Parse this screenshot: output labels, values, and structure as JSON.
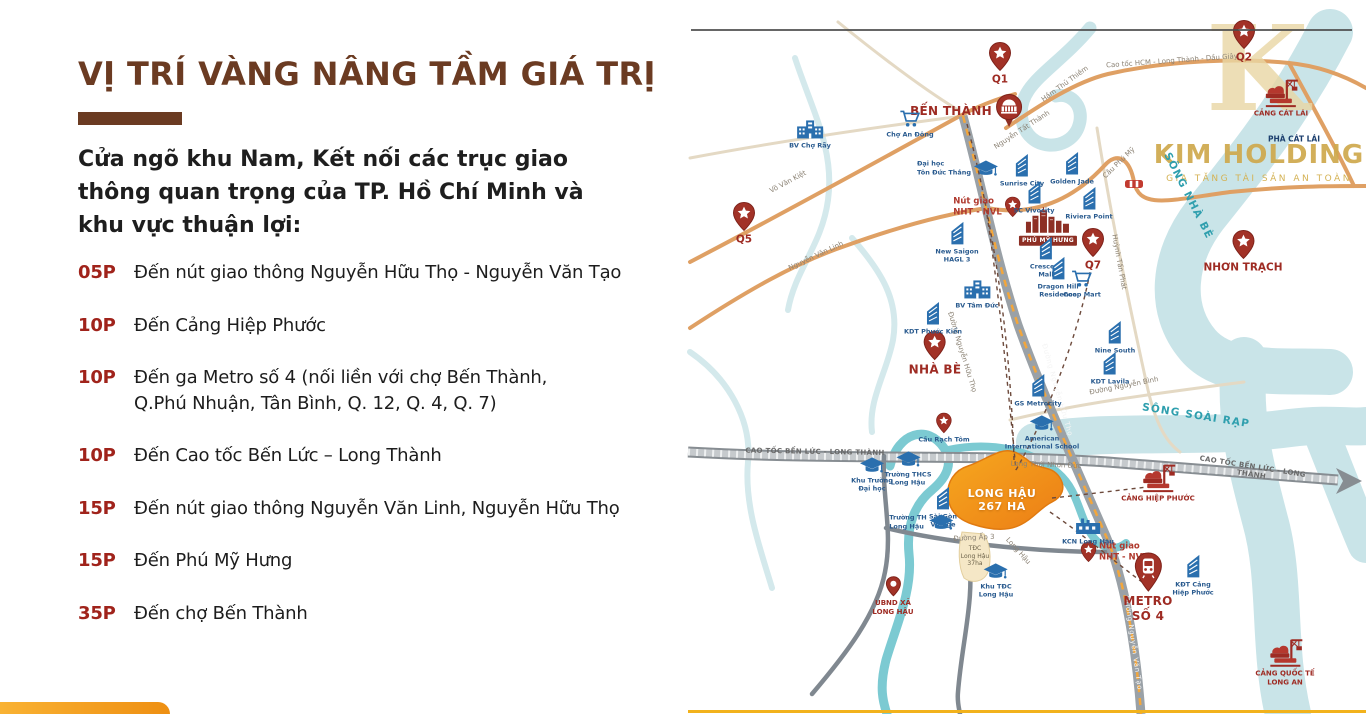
{
  "left": {
    "title": "VỊ TRÍ VÀNG NÂNG TẦM GIÁ TRỊ",
    "intro_lines": [
      "Cửa ngõ khu Nam, Kết nối các trục giao",
      "thông quan trọng của TP. Hồ Chí Minh và",
      "khu vực thuận lợi:"
    ],
    "items": [
      {
        "time": "05P",
        "text": "Đến nút giao thông Nguyễn Hữu Thọ - Nguyễn Văn Tạo"
      },
      {
        "time": "10P",
        "text": "Đến Cảng Hiệp Phước"
      },
      {
        "time": "10P",
        "text": "Đến ga Metro số 4 (nối liền với chợ Bến Thành,\nQ.Phú Nhuận, Tân Bình, Q. 12, Q. 4, Q. 7)"
      },
      {
        "time": "10P",
        "text": "Đến Cao tốc Bến Lức – Long Thành"
      },
      {
        "time": "15P",
        "text": "Đến nút giao thông Nguyễn Văn Linh, Nguyễn Hữu Thọ"
      },
      {
        "time": "15P",
        "text": "Đến Phú Mỹ Hưng"
      },
      {
        "time": "35P",
        "text": "Đến  chợ Bến Thành"
      }
    ]
  },
  "watermark": {
    "letter": "K",
    "brand": "KIM HOLDING",
    "tagline": "GIA TĂNG TÀI SẢN AN TOÀN"
  },
  "colors": {
    "accent_brown": "#6b3b22",
    "time_red": "#a0231b",
    "pin_red": "#a23227",
    "river_teal": "#c9e4e8",
    "road_orange": "#dfa064",
    "site_orange": "#f08c1e",
    "gold": "#cfa94d"
  },
  "map": {
    "markers": [
      {
        "id": "q1",
        "t": "star",
        "x": 1000,
        "y": 64,
        "l": "Q1",
        "lp": "b",
        "lc": "red-md"
      },
      {
        "id": "q2",
        "t": "star",
        "x": 1244,
        "y": 42,
        "l": "Q2",
        "lp": "b",
        "lc": "red-md"
      },
      {
        "id": "q5",
        "t": "star",
        "x": 744,
        "y": 224,
        "l": "Q5",
        "lp": "b",
        "lc": "red-md"
      },
      {
        "id": "q7",
        "t": "star",
        "x": 1093,
        "y": 250,
        "l": "Q7",
        "lp": "b",
        "lc": "red-md"
      },
      {
        "id": "nhon-trach",
        "t": "star",
        "x": 1243,
        "y": 252,
        "l": "NHƠN TRẠCH",
        "lp": "b",
        "lc": "red-md"
      },
      {
        "id": "nha-be",
        "t": "star",
        "x": 935,
        "y": 354,
        "l": "NHÀ BÈ",
        "lp": "b",
        "lc": "red-lg"
      },
      {
        "id": "nut-giao-nht-nvl",
        "t": "star-sm",
        "x": 987,
        "y": 207,
        "l": "Nút giao\nNHT - NVL",
        "lp": "l",
        "lc": "red-sm"
      },
      {
        "id": "nut-giao-nht-nvt",
        "t": "star-sm",
        "x": 1114,
        "y": 552,
        "l": "Nút giao\nNHT - NVT",
        "lp": "r",
        "lc": "red-sm"
      },
      {
        "id": "cau-rach-tom",
        "t": "star-sm",
        "x": 944,
        "y": 428,
        "l": "Cầu Rạch Tôm",
        "lp": "b",
        "lc": "navy"
      },
      {
        "id": "ben-thanh",
        "t": "market",
        "x": 967,
        "y": 111,
        "l": "BẾN THÀNH",
        "lp": "l",
        "lc": "red-lg"
      },
      {
        "id": "metro-so-4",
        "t": "train",
        "x": 1148,
        "y": 588,
        "l": "METRO\nSỐ 4",
        "lp": "b",
        "lc": "red-lg"
      },
      {
        "id": "ubnd-long-hau",
        "t": "dot",
        "x": 893,
        "y": 596,
        "l": "UBND XÃ\nLONG HẬU",
        "lp": "b",
        "lc": "red-xs"
      },
      {
        "id": "cang-cat-lai",
        "t": "port",
        "x": 1281,
        "y": 98,
        "l": "CẢNG CÁT LÁI",
        "lp": "b",
        "lc": "red-xs"
      },
      {
        "id": "cang-hiep-phuoc",
        "t": "port",
        "x": 1158,
        "y": 483,
        "l": "CẢNG HIỆP PHƯỚC",
        "lp": "b",
        "lc": "red-xs"
      },
      {
        "id": "cang-quoc-te-long-an",
        "t": "port",
        "x": 1285,
        "y": 662,
        "l": "CẢNG QUỐC TẾ\nLONG AN",
        "lp": "b",
        "lc": "red-xs"
      },
      {
        "id": "phu-my-hung",
        "t": "skyline",
        "x": 1048,
        "y": 226,
        "l": "PHÚ MỸ HƯNG",
        "lp": "b",
        "lc": "plate"
      },
      {
        "id": "cau-phu-my-bridge",
        "t": "bridge",
        "x": 1134,
        "y": 184,
        "l": "",
        "lp": "b",
        "lc": "navy"
      },
      {
        "id": "sunrise-city",
        "t": "bld",
        "x": 1022,
        "y": 169,
        "l": "Sunrise City",
        "lp": "b",
        "lc": "navy"
      },
      {
        "id": "golden-jade",
        "t": "bld",
        "x": 1072,
        "y": 167,
        "l": "Golden Jade",
        "lp": "b",
        "lc": "navy"
      },
      {
        "id": "sc-vivocity",
        "t": "bld",
        "x": 1034,
        "y": 196,
        "l": "SC Vivocity",
        "lp": "b",
        "lc": "navy"
      },
      {
        "id": "riviera-point",
        "t": "bld",
        "x": 1089,
        "y": 202,
        "l": "Riviera Point",
        "lp": "b",
        "lc": "navy"
      },
      {
        "id": "new-saigon-hagl3",
        "t": "bld",
        "x": 957,
        "y": 241,
        "l": "New Saigon\nHAGL 3",
        "lp": "b",
        "lc": "navy"
      },
      {
        "id": "crescent-mall",
        "t": "bld",
        "x": 1046,
        "y": 256,
        "l": "Crescent\nMall",
        "lp": "b",
        "lc": "navy"
      },
      {
        "id": "dragon-hill",
        "t": "bld",
        "x": 1058,
        "y": 276,
        "l": "Dragon Hill\nResidence",
        "lp": "b",
        "lc": "navy"
      },
      {
        "id": "coop-mart",
        "t": "cart",
        "x": 1082,
        "y": 284,
        "l": "Coop Mart",
        "lp": "b",
        "lc": "navy"
      },
      {
        "id": "nine-south",
        "t": "bld",
        "x": 1115,
        "y": 336,
        "l": "Nine South",
        "lp": "b",
        "lc": "navy"
      },
      {
        "id": "kdt-lavila",
        "t": "bld",
        "x": 1110,
        "y": 367,
        "l": "KDT Lavila",
        "lp": "b",
        "lc": "navy"
      },
      {
        "id": "gs-metrocity",
        "t": "bld",
        "x": 1038,
        "y": 389,
        "l": "GS Metrocity",
        "lp": "b",
        "lc": "navy"
      },
      {
        "id": "kdt-phuoc-kien",
        "t": "bld",
        "x": 933,
        "y": 317,
        "l": "KDT Phước Kiển",
        "lp": "b",
        "lc": "navy"
      },
      {
        "id": "sai-gon-village",
        "t": "bld",
        "x": 943,
        "y": 506,
        "l": "Sài Gòn\nVillage",
        "lp": "b",
        "lc": "navy"
      },
      {
        "id": "kdt-cang-hiep-phuoc",
        "t": "bld",
        "x": 1193,
        "y": 574,
        "l": "KĐT Cảng\nHiệp Phước",
        "lp": "b",
        "lc": "navy"
      },
      {
        "id": "bv-cho-ray",
        "t": "hosp",
        "x": 810,
        "y": 134,
        "l": "BV Chợ Rẫy",
        "lp": "b",
        "lc": "navy"
      },
      {
        "id": "bv-tam-duc",
        "t": "hosp",
        "x": 977,
        "y": 294,
        "l": "BV Tâm Đức",
        "lp": "b",
        "lc": "navy"
      },
      {
        "id": "cho-an-dong",
        "t": "cart",
        "x": 910,
        "y": 124,
        "l": "Chợ An Đông",
        "lp": "b",
        "lc": "navy"
      },
      {
        "id": "dh-ton-duc-thang",
        "t": "school",
        "x": 958,
        "y": 168,
        "l": "Đại học\nTôn Đức Thắng",
        "lp": "l",
        "lc": "navy"
      },
      {
        "id": "american-intl-school",
        "t": "school",
        "x": 1042,
        "y": 432,
        "l": "American\nInternational School",
        "lp": "b",
        "lc": "navy"
      },
      {
        "id": "khu-truong-dai-hoc",
        "t": "school",
        "x": 872,
        "y": 474,
        "l": "Khu Trường\nĐại học",
        "lp": "b",
        "lc": "navy"
      },
      {
        "id": "thcs-long-hau",
        "t": "school",
        "x": 908,
        "y": 468,
        "l": "Trường THCS\nLong Hậu",
        "lp": "b",
        "lc": "navy"
      },
      {
        "id": "th-long-hau",
        "t": "school",
        "x": 922,
        "y": 522,
        "l": "Trường TH\nLong Hậu",
        "lp": "l",
        "lc": "navy"
      },
      {
        "id": "khu-tdc-long-hau",
        "t": "school",
        "x": 996,
        "y": 580,
        "l": "Khu TĐC\nLong Hậu",
        "lp": "b",
        "lc": "navy"
      },
      {
        "id": "kcn-long-hau",
        "t": "factory",
        "x": 1088,
        "y": 530,
        "l": "KCN Long Hậu",
        "lp": "b",
        "lc": "navy"
      }
    ],
    "texts": [
      {
        "t": "Võ Văn Kiệt",
        "x": 788,
        "y": 182,
        "r": -28,
        "c": "road"
      },
      {
        "t": "Nguyễn Tất Thành",
        "x": 1022,
        "y": 130,
        "r": -33,
        "c": "road"
      },
      {
        "t": "Hầm Thủ Thiêm",
        "x": 1065,
        "y": 84,
        "r": -36,
        "c": "road"
      },
      {
        "t": "Cao tốc HCM - Long Thành - Dầu Giây",
        "x": 1172,
        "y": 61,
        "r": -4,
        "c": "road"
      },
      {
        "t": "Nguyễn Văn Linh",
        "x": 816,
        "y": 256,
        "r": -25,
        "c": "road"
      },
      {
        "t": "Cầu Phú Mỹ",
        "x": 1119,
        "y": 163,
        "r": -44,
        "c": "road"
      },
      {
        "t": "Huỳnh Tấn Phát",
        "x": 1119,
        "y": 262,
        "r": 80,
        "c": "road"
      },
      {
        "t": "Đường Nguyễn Bình",
        "x": 1124,
        "y": 386,
        "r": -11,
        "c": "road"
      },
      {
        "t": "Đường Nguyễn Hữu Thọ",
        "x": 962,
        "y": 352,
        "r": 73,
        "c": "road"
      },
      {
        "t": "Đường Nguyễn Hữu Thọ",
        "x": 1057,
        "y": 390,
        "r": 74,
        "c": "roadw"
      },
      {
        "t": "Đường Nguyễn Văn Tạo",
        "x": 1133,
        "y": 643,
        "r": 82,
        "c": "roadw"
      },
      {
        "t": "CAO TỐC BẾN LỨC - LONG THÀNH",
        "x": 815,
        "y": 452,
        "r": 1,
        "c": "roadb"
      },
      {
        "t": "CAO TỐC BẾN LỨC - LONG THÀNH",
        "x": 1252,
        "y": 471,
        "r": 9,
        "c": "roadb"
      },
      {
        "t": "Long Thới Nhơn Đức",
        "x": 1046,
        "y": 465,
        "r": 2,
        "c": "road"
      },
      {
        "t": "Đường Ấp 3",
        "x": 974,
        "y": 538,
        "r": -3,
        "c": "road"
      },
      {
        "t": "Long Hậu",
        "x": 1018,
        "y": 551,
        "r": 48,
        "c": "road"
      },
      {
        "t": "SÔNG NHÀ BÈ",
        "x": 1188,
        "y": 196,
        "r": 63,
        "c": "river"
      },
      {
        "t": "SÔNG SOÀI RẠP",
        "x": 1196,
        "y": 416,
        "r": 9,
        "c": "river"
      },
      {
        "t": "PHÀ CÁT LÁI",
        "x": 1294,
        "y": 139,
        "r": 0,
        "c": "navyb"
      },
      {
        "t": "LONG HẬU\n267 HA",
        "x": 1002,
        "y": 500,
        "r": 0,
        "c": "site"
      },
      {
        "t": "TĐC\nLong Hậu\n37ha",
        "x": 975,
        "y": 556,
        "r": 0,
        "c": "navyxs"
      }
    ]
  }
}
